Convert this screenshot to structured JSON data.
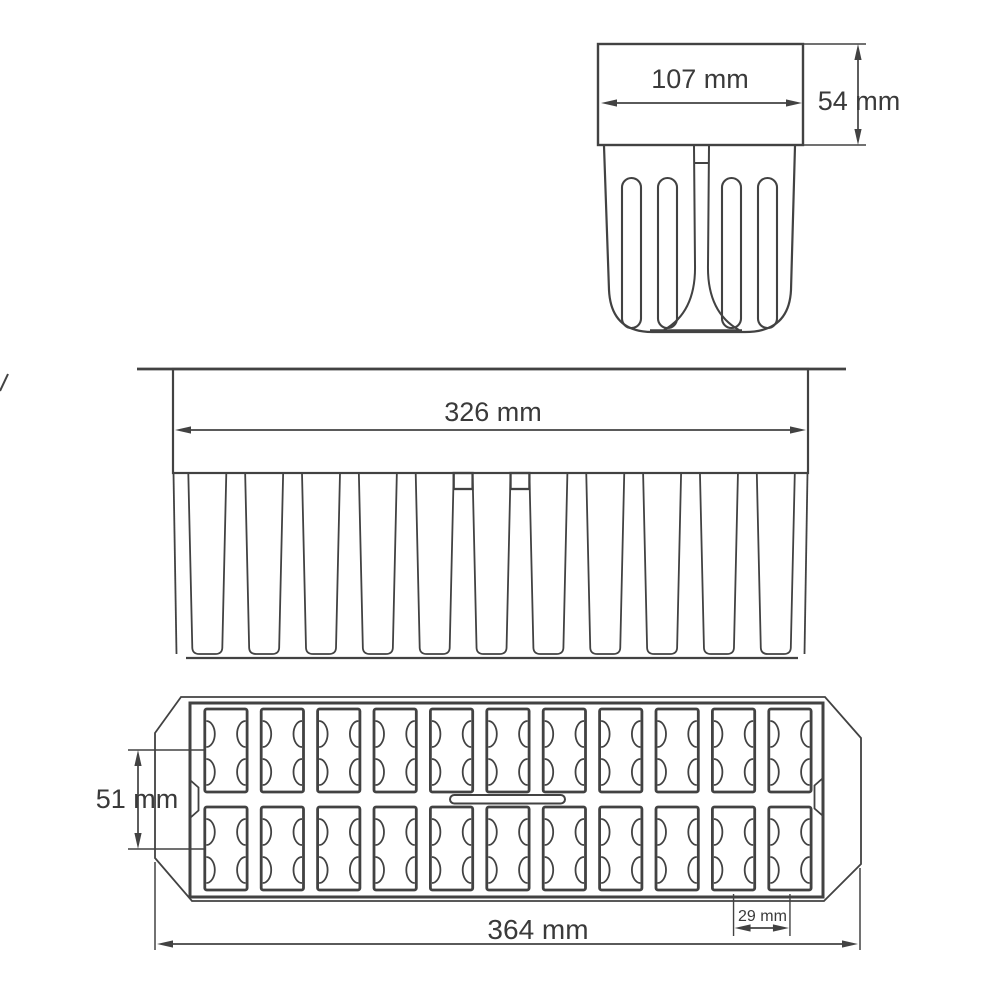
{
  "drawing": {
    "line_color": "#424242",
    "text_color": "#3a3a3a",
    "background_color": "#ffffff",
    "views": {
      "unit_side": {
        "name": "single-mold-unit-side-view",
        "width_label": "107 mm",
        "height_label": "54 mm",
        "slot_count": 4
      },
      "front": {
        "name": "tray-front-elevation",
        "width_label": "326 mm",
        "mold_count": 11,
        "support_post_count": 2
      },
      "plan": {
        "name": "tray-top-view",
        "length_label": "364 mm",
        "row_pitch_label": "51 mm",
        "column_pitch_label": "29 mm",
        "columns": 11,
        "rows": 2,
        "cavity_count": 22
      }
    }
  }
}
